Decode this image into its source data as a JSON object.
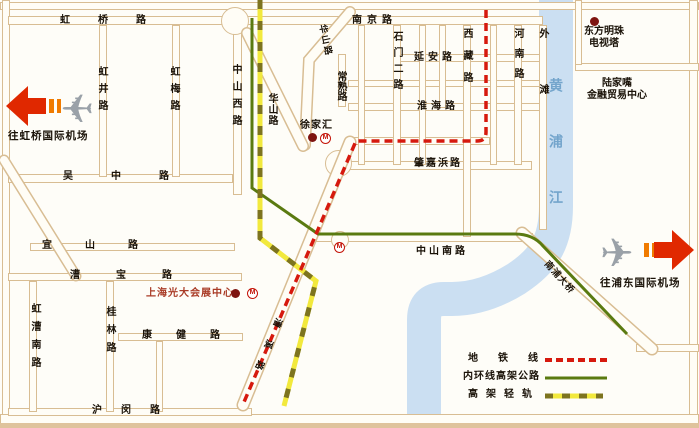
{
  "roads": {
    "hongqiao": "虹桥路",
    "nanjing": "南京路",
    "yanan": "延安路",
    "huaihai": "淮海路",
    "zhaojiabang": "肇嘉浜路",
    "zhongshan_south": "中山南路",
    "wuzhong": "吴中路",
    "yishan": "宜山路",
    "caobao": "漕宝路",
    "kangjian": "康健路",
    "humin": "沪闵路",
    "hongjing": "虹井路",
    "hongmei": "虹梅路",
    "zhongshan_west": "中山西路",
    "huashan_diag": "华山路",
    "huashan_vert": "华山路",
    "changshu": "常熟路",
    "shimen_er": "石门二路",
    "xizang": "西藏路",
    "henan": "河南路",
    "waitan": "外滩",
    "hongcao_south": "虹漕南路",
    "guilin": "桂林路",
    "caoxi": "漕溪路",
    "nanpu_bridge": "南浦大桥"
  },
  "pois": {
    "xujiahui": "徐家汇",
    "pearl_1": "东方明珠",
    "pearl_2": "电视塔",
    "lujiazui_1": "陆家嘴",
    "lujiazui_2": "金融贸易中心",
    "everbright": "上海光大会展中心",
    "to_hongqiao": "往虹桥国际机场",
    "to_pudong": "往浦东国际机场",
    "river": "黄浦江"
  },
  "legend": {
    "metro": "地铁线",
    "ring": "内环线高架公路",
    "lightrail": "高架轻轨"
  },
  "icons": {
    "metro_logo": "M"
  },
  "colors": {
    "metro_red": "#d6190e",
    "ring_green": "#5a7a10",
    "lightrail_yellow": "#f2e93d",
    "lightrail_olive": "#7d741f",
    "river_blue": "#cbdff2",
    "river_text": "#74a5cc",
    "road_edge": "#d8bd93",
    "poi_red": "#a93b26",
    "dot_red": "#7e1410",
    "arrow_red": "#e02800",
    "arrow_orange": "#f07b00"
  }
}
